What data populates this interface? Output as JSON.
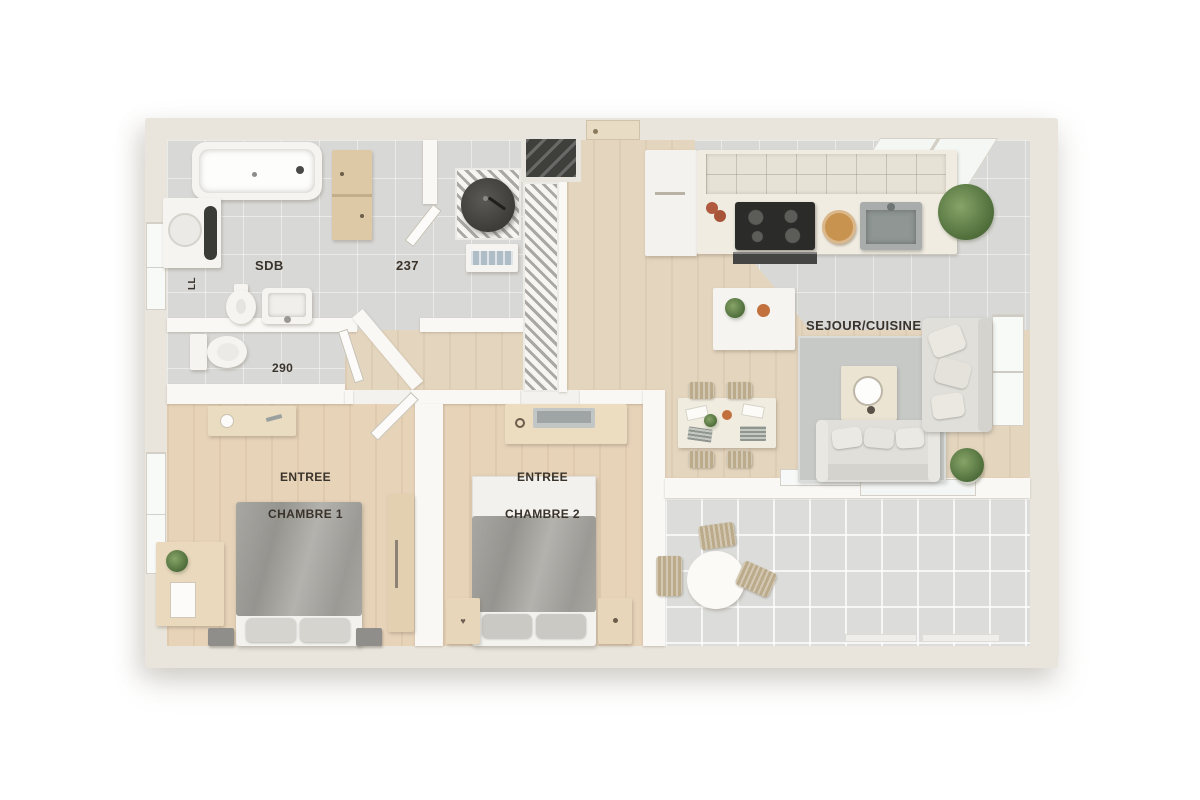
{
  "title": "Plan 3D appartement - vue de dessus",
  "rooms": [
    {
      "id": "sdb",
      "label": "SDB"
    },
    {
      "id": "piece-237",
      "label": "237"
    },
    {
      "id": "wc-290",
      "label": "290"
    },
    {
      "id": "entree-chambre-1",
      "label": "ENTREE"
    },
    {
      "id": "chambre-1",
      "label": "CHAMBRE 1"
    },
    {
      "id": "entree-chambre-2",
      "label": "ENTREE"
    },
    {
      "id": "chambre-2",
      "label": "CHAMBRE 2"
    },
    {
      "id": "sejour-cuisine",
      "label": "SEJOUR/CUISINE"
    }
  ],
  "annotations": {
    "washing_machine": "LL"
  },
  "icons": {
    "heart": "♥"
  },
  "palette": {
    "background": "#ffffff",
    "outer_wall": "#e9e5dc",
    "inner_wall": "#f9f8f5",
    "tile_floor": "#d8d8d6",
    "terrace_floor": "#dcddda",
    "wood_floor": "#e4d5be",
    "bedroom_floor": "#e7d3b8",
    "rug": "#c7c9c7",
    "label_text": "#3a332b",
    "appliance_dark": "#3b3a37",
    "plant_green": "#4d6c39",
    "wood_furniture": "#e6d5b4"
  }
}
